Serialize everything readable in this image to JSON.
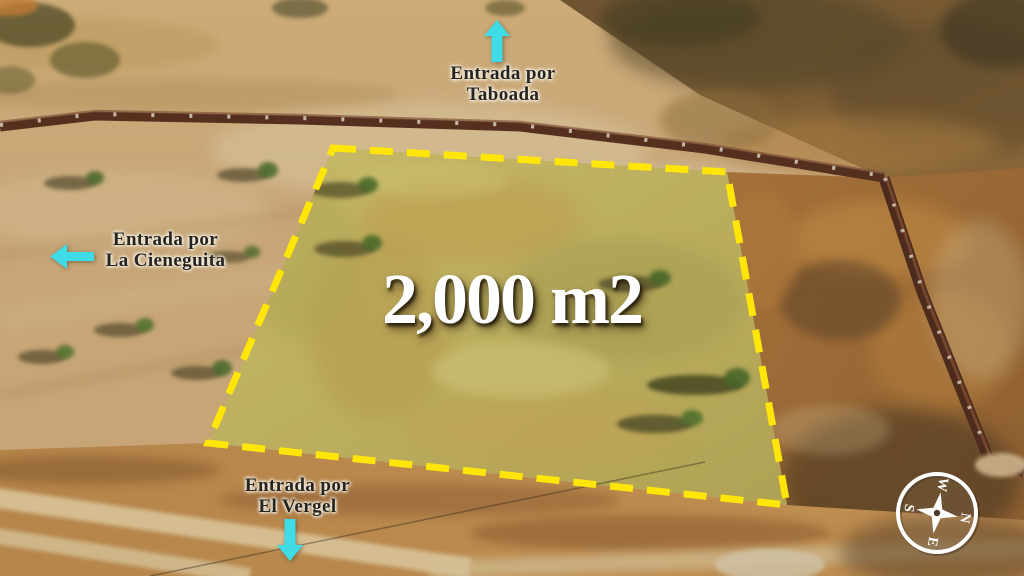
{
  "annotations": {
    "area_label": "2,000 m2",
    "entrance_top": {
      "line1": "Entrada por",
      "line2": "Taboada"
    },
    "entrance_left": {
      "line1": "Entrada por",
      "line2": "La Cieneguita"
    },
    "entrance_bottom": {
      "line1": "Entrada por",
      "line2": "El Vergel"
    }
  },
  "compass": {
    "north": "N",
    "east": "E",
    "south": "S",
    "west": "W"
  },
  "colors": {
    "plot_outline": "#ffe608",
    "arrow": "#3fdbe6",
    "area_text": "#ffffff",
    "entrance_text": "#262420",
    "compass": "#ffffff"
  }
}
